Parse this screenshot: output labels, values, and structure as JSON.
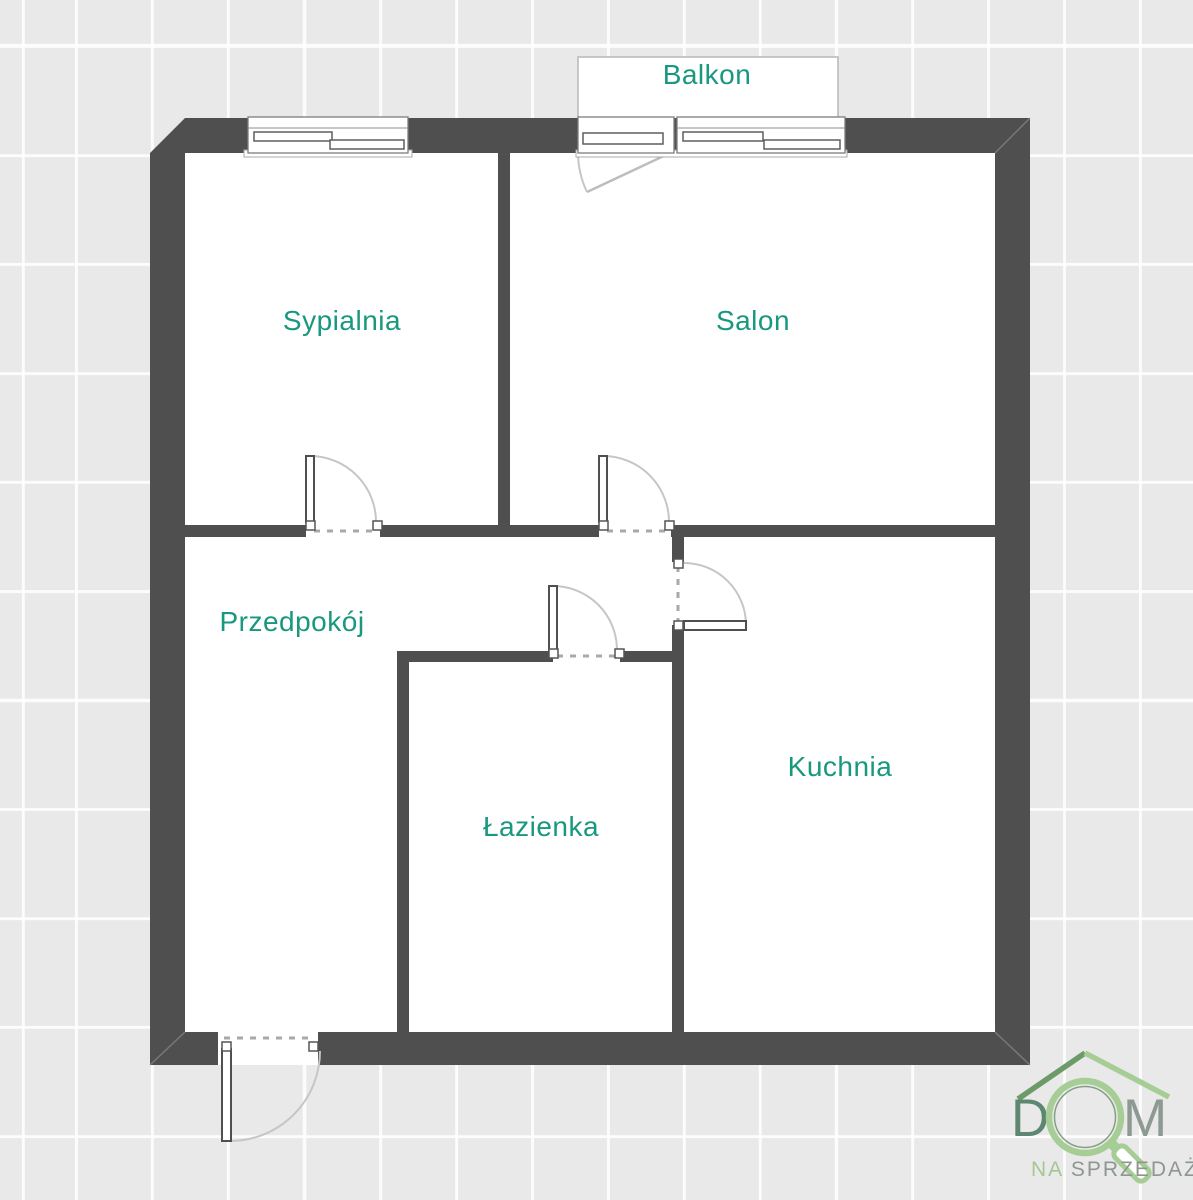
{
  "plan": {
    "background_color": "#e9e9e9",
    "grid_line_color": "#ffffff",
    "wall_color": "#4f4f4f",
    "room_fill_color": "#ffffff",
    "label_color": "#18987f",
    "rooms": [
      {
        "name": "Balkon"
      },
      {
        "name": "Sypialnia"
      },
      {
        "name": "Salon"
      },
      {
        "name": "Przedpokój"
      },
      {
        "name": "Łazienka"
      },
      {
        "name": "Kuchnia"
      }
    ]
  },
  "logo": {
    "letter_d": "D",
    "letter_m": "M",
    "tagline_na": "NA",
    "tagline_rest": "SPRZEDAŻ",
    "colors": {
      "roof_left": "#6d9b68",
      "roof_right": "#a7cd97",
      "letter_d": "#5d8770",
      "letter_m": "#8d9a93",
      "magnifier": "#a7cd97",
      "tagline_na": "#a4c795",
      "tagline_rest": "#8f9691"
    }
  }
}
